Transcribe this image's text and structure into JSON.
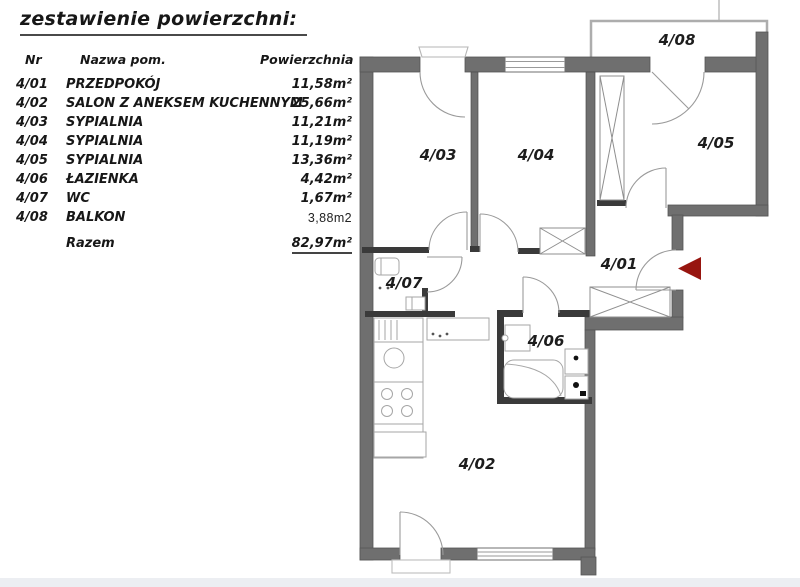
{
  "title": "zestawienie powierzchni:",
  "table": {
    "headers": {
      "nr": "Nr",
      "name": "Nazwa pom.",
      "area": "Powierzchnia"
    },
    "rows": [
      {
        "nr": "4/01",
        "name": "PRZEDPOKÓJ",
        "area": "11,58m²"
      },
      {
        "nr": "4/02",
        "name": "SALON Z ANEKSEM KUCHENNYM",
        "area": "25,66m²"
      },
      {
        "nr": "4/03",
        "name": "SYPIALNIA",
        "area": "11,21m²"
      },
      {
        "nr": "4/04",
        "name": "SYPIALNIA",
        "area": "11,19m²"
      },
      {
        "nr": "4/05",
        "name": "SYPIALNIA",
        "area": "13,36m²"
      },
      {
        "nr": "4/06",
        "name": "ŁAZIENKA",
        "area": "4,42m²"
      },
      {
        "nr": "4/07",
        "name": "WC",
        "area": "1,67m²"
      },
      {
        "nr": "4/08",
        "name": "BALKON",
        "area": "3,88m2"
      }
    ],
    "total_label": "Razem",
    "total_area": "82,97m²"
  },
  "plan": {
    "room_labels": [
      "4/03",
      "4/04",
      "4/05",
      "4/08",
      "4/01",
      "4/07",
      "4/06",
      "4/02"
    ],
    "colors": {
      "wall": "#6f6f6f",
      "thin_wall": "#3a3a3a",
      "fixture": "#a6a6a6",
      "entrance_arrow": "#97150f",
      "label_text": "#1d1d1d"
    }
  }
}
